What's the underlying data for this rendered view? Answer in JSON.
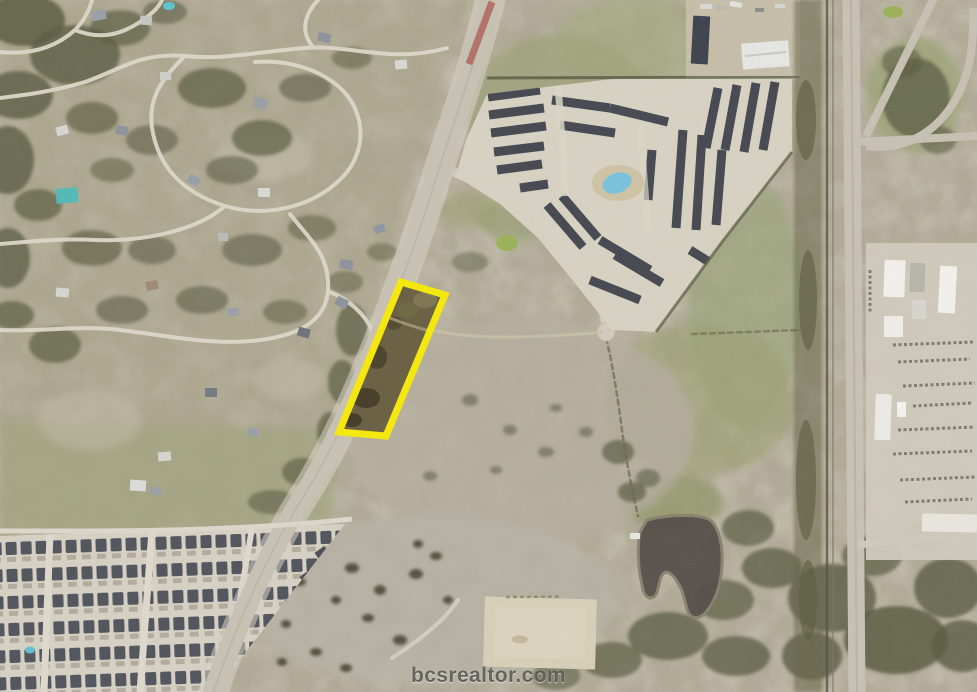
{
  "map": {
    "kind": "satellite-aerial-photo",
    "watermark_text": "bcsrealtor.com",
    "parcel": {
      "points": "401,282 445,295 386,436 339,432",
      "outline_color": "#F6E90D",
      "outline_width": "7",
      "fill_color": "#6B6144"
    },
    "palette": {
      "terrain": "#B3AC98",
      "road": "#C8C2B5",
      "road_light": "#DCD7CA",
      "trees": "#5C5E43",
      "pond": "#55504A",
      "pool_blue": "#7AC2DD",
      "roof_dark": "#474A52",
      "concrete": "#D8D2C3",
      "median_red": "#B2655E"
    }
  }
}
